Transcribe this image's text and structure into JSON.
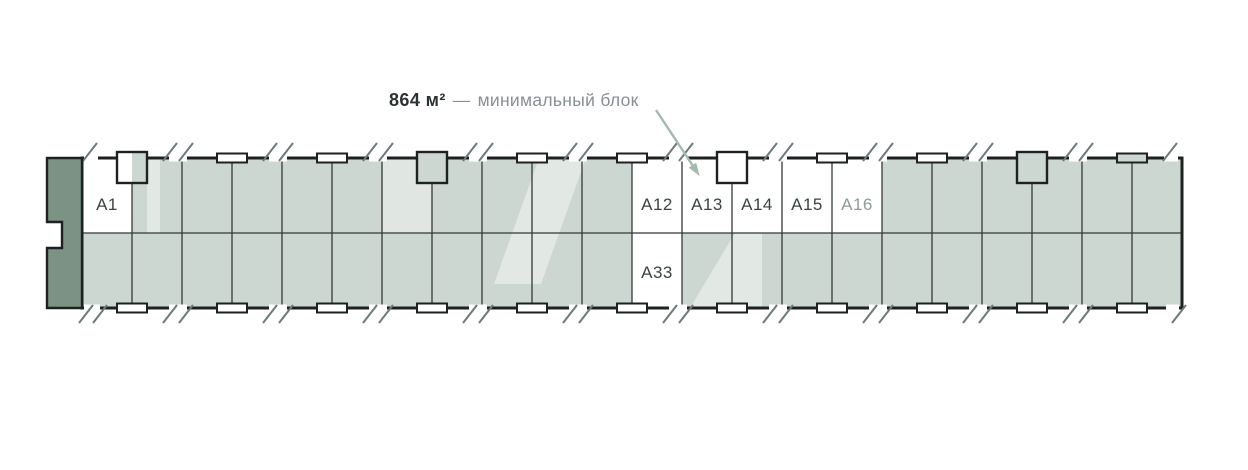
{
  "title": {
    "area": "864 м²",
    "dash": "—",
    "label": "минимальный блок"
  },
  "plan": {
    "units": [
      {
        "id": "A1",
        "label": "A1",
        "row": "top",
        "col": 0,
        "muted": false
      },
      {
        "id": "A12",
        "label": "A12",
        "row": "top",
        "col": 11,
        "muted": false
      },
      {
        "id": "A13",
        "label": "A13",
        "row": "top",
        "col": 12,
        "muted": false
      },
      {
        "id": "A14",
        "label": "A14",
        "row": "top",
        "col": 13,
        "muted": false
      },
      {
        "id": "A15",
        "label": "A15",
        "row": "top",
        "col": 14,
        "muted": false
      },
      {
        "id": "A16",
        "label": "A16",
        "row": "top",
        "col": 15,
        "muted": true
      },
      {
        "id": "A33",
        "label": "A33",
        "row": "bottom",
        "col": 11,
        "muted": false
      }
    ]
  },
  "colors": {
    "cell_fill": "#cdd7d1",
    "cap_fill": "#7b9284",
    "outline": "#1d2122",
    "grid_line": "#33383a",
    "label": "#3b4344",
    "label_muted": "#8f999b",
    "title_dark": "#2c3234",
    "title_gray": "#879094",
    "arrow": "#a5b9ae",
    "wall_break": "#6e797b"
  }
}
